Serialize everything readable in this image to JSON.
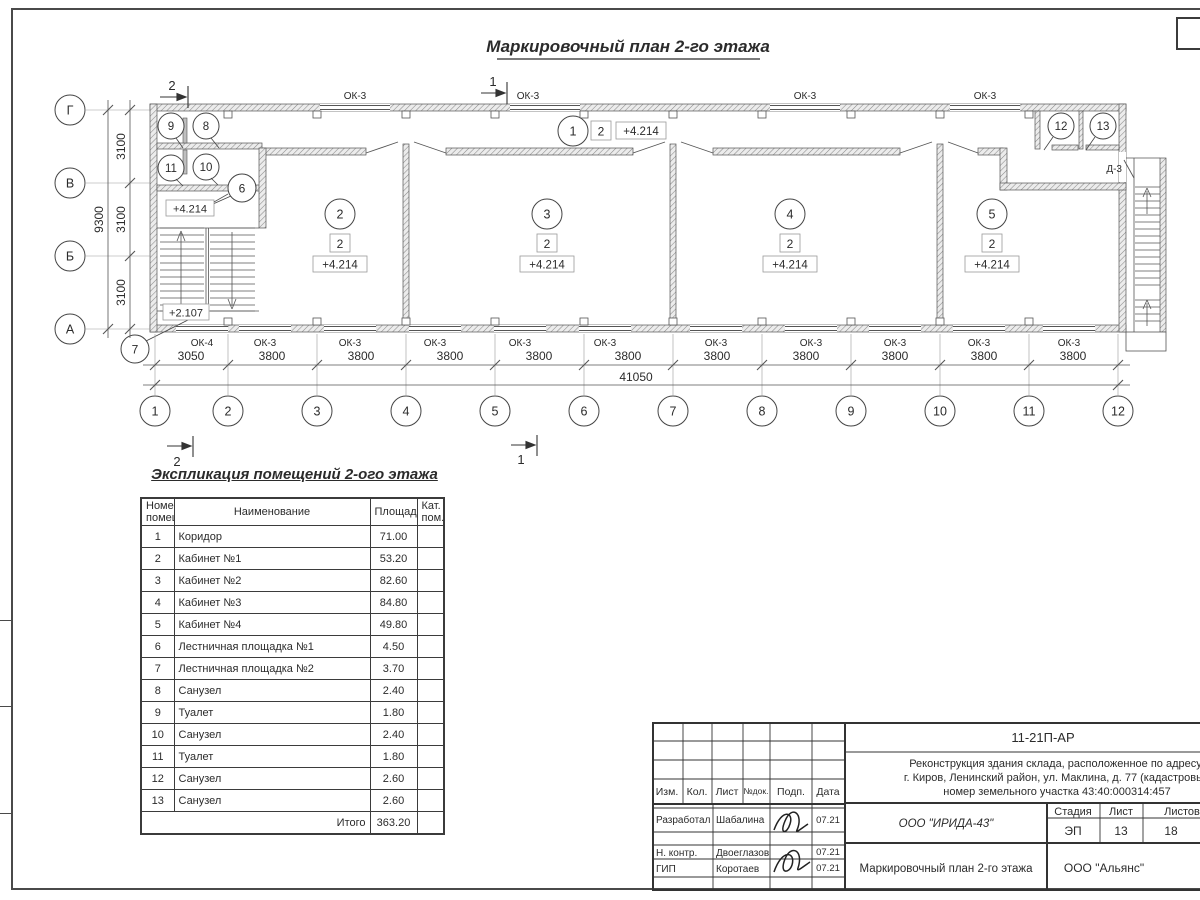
{
  "plan": {
    "title": "Маркировочный план 2-го этажа",
    "axes_h": [
      "1",
      "2",
      "3",
      "4",
      "5",
      "6",
      "7",
      "8",
      "9",
      "10",
      "11",
      "12"
    ],
    "axes_v": [
      "Г",
      "В",
      "Б",
      "А"
    ],
    "bay_dims": [
      "3050",
      "3800",
      "3800",
      "3800",
      "3800",
      "3800",
      "3800",
      "3800",
      "3800",
      "3800",
      "3800"
    ],
    "total_width": "41050",
    "floor_dims": [
      "3100",
      "3100",
      "3100"
    ],
    "total_height": "9300",
    "windows_top": [
      "ОК-3",
      "ОК-3",
      "ОК-3",
      "ОК-3"
    ],
    "windows_bottom": [
      "ОК-4",
      "ОК-3",
      "ОК-3",
      "ОК-3",
      "ОК-3",
      "ОК-3",
      "ОК-3",
      "ОК-3",
      "ОК-3",
      "ОК-3",
      "ОК-3"
    ],
    "door_label": "Д-3",
    "section_1": "1",
    "section_2": "2",
    "elevation": "+4.214",
    "elevation_stair": "+2.107",
    "category": "2",
    "room_markers": {
      "r1": "1",
      "r2": "2",
      "r3": "3",
      "r4": "4",
      "r5": "5",
      "r6": "6",
      "r7": "7",
      "r8": "8",
      "r9": "9",
      "r10": "10",
      "r11": "11",
      "r12": "12",
      "r13": "13"
    }
  },
  "schedule": {
    "title": "Экспликация помещений 2-ого этажа",
    "col_num_l1": "Номер",
    "col_num_l2": "помещ.",
    "col_name": "Наименование",
    "col_area": "Площадь",
    "col_cat_l1": "Кат.",
    "col_cat_l2": "пом.",
    "rows": [
      {
        "n": "1",
        "name": "Коридор",
        "area": "71.00"
      },
      {
        "n": "2",
        "name": "Кабинет №1",
        "area": "53.20"
      },
      {
        "n": "3",
        "name": "Кабинет №2",
        "area": "82.60"
      },
      {
        "n": "4",
        "name": "Кабинет №3",
        "area": "84.80"
      },
      {
        "n": "5",
        "name": "Кабинет №4",
        "area": "49.80"
      },
      {
        "n": "6",
        "name": "Лестничная площадка №1",
        "area": "4.50"
      },
      {
        "n": "7",
        "name": "Лестничная площадка №2",
        "area": "3.70"
      },
      {
        "n": "8",
        "name": "Санузел",
        "area": "2.40"
      },
      {
        "n": "9",
        "name": "Туалет",
        "area": "1.80"
      },
      {
        "n": "10",
        "name": "Санузел",
        "area": "2.40"
      },
      {
        "n": "11",
        "name": "Туалет",
        "area": "1.80"
      },
      {
        "n": "12",
        "name": "Санузел",
        "area": "2.60"
      },
      {
        "n": "13",
        "name": "Санузел",
        "area": "2.60"
      }
    ],
    "total_label": "Итого",
    "total_value": "363.20"
  },
  "titleblock": {
    "doc_number": "11-21П-АР",
    "desc1": "Реконструкция здания склада, расположенное по адресу:",
    "desc2": "г. Киров, Ленинский район, ул. Маклина, д. 77 (кадастровый",
    "desc3": "номер земельного участка 43:40:000314:457",
    "cols": [
      "Изм.",
      "Кол.",
      "Лист",
      "№док.",
      "Подп.",
      "Дата"
    ],
    "staff": [
      {
        "role": "Разработал",
        "name": "Шабалина",
        "date": "07.21"
      },
      {
        "role": "Н. контр.",
        "name": "Двоеглазов",
        "date": "07.21"
      },
      {
        "role": "ГИП",
        "name": "Коротаев",
        "date": "07.21"
      }
    ],
    "org": "ООО \"ИРИДА-43\"",
    "stage_label": "Стадия",
    "sheet_label": "Лист",
    "sheets_label": "Листов",
    "stage": "ЭП",
    "sheet": "13",
    "sheets": "18",
    "drawing_title": "Маркировочный план 2-го этажа",
    "org2": "ООО \"Альянс\""
  }
}
